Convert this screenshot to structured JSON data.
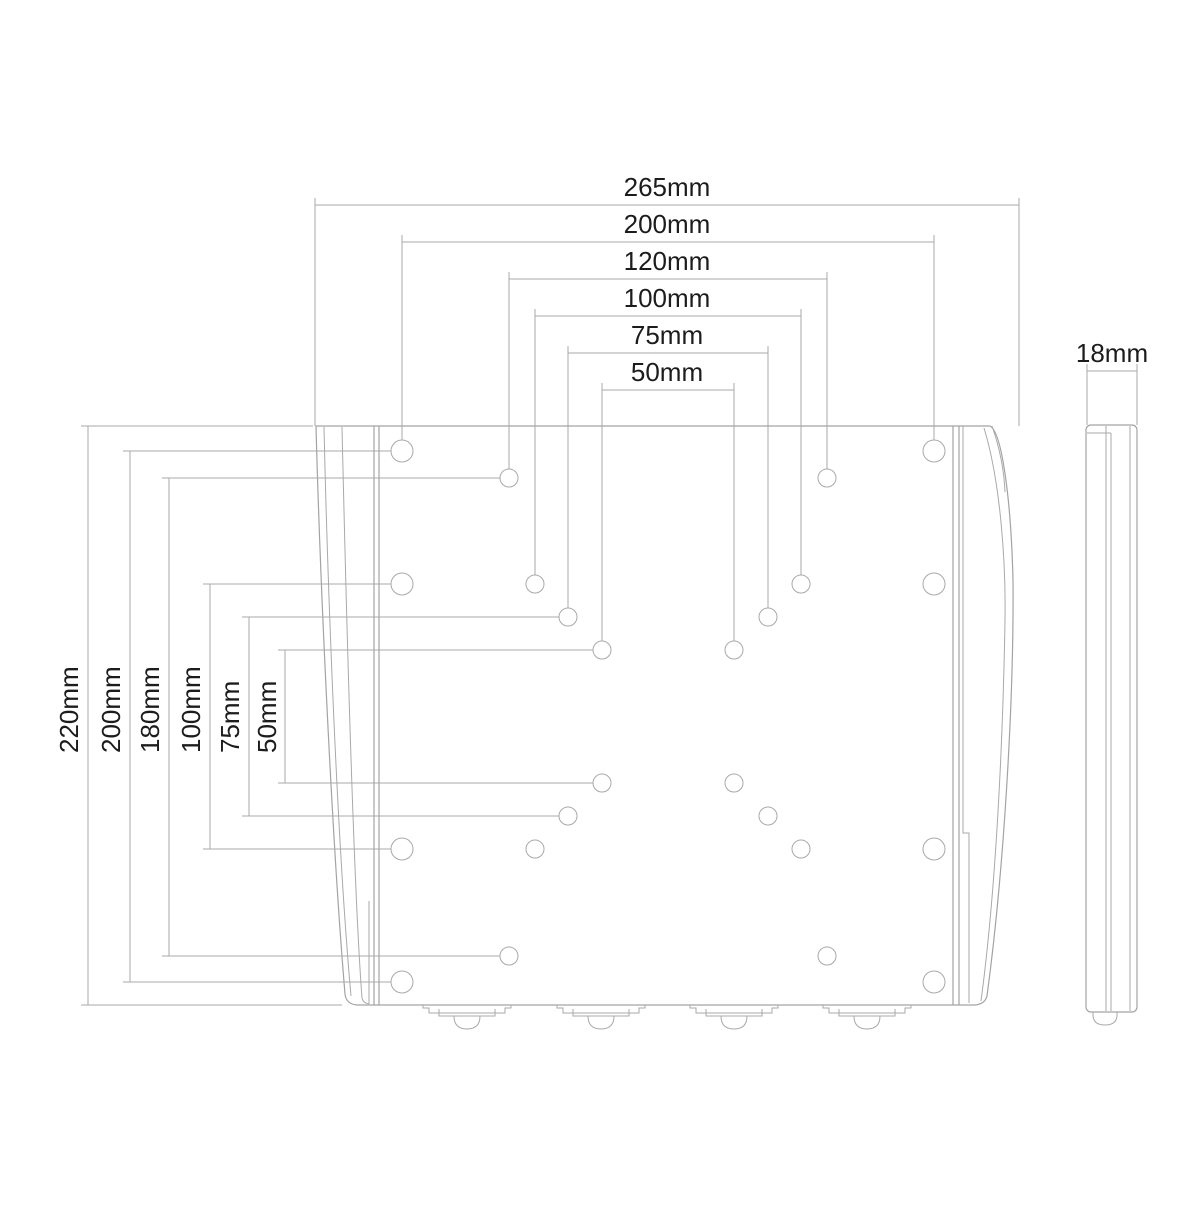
{
  "drawing": {
    "description": "VESA TV wall mount bracket dimensional drawing, front view and side view",
    "colors": {
      "line": "#a9a9a9",
      "plate_line": "#a3a3a3",
      "text": "#1c1c1c",
      "background": "#ffffff"
    },
    "front_view": {
      "plate": {
        "left": 316,
        "top": 426,
        "right": 1016,
        "bottom": 1005
      },
      "horizontal_dims": [
        {
          "label": "265mm",
          "value_mm": 265,
          "y": 205,
          "x1": 315,
          "x2": 1019,
          "ext_to": 426
        },
        {
          "label": "200mm",
          "value_mm": 200,
          "y": 242,
          "x1": 402,
          "x2": 934,
          "ext_to": 440
        },
        {
          "label": "120mm",
          "value_mm": 120,
          "y": 279,
          "x1": 509,
          "x2": 827,
          "ext_to": 469
        },
        {
          "label": "100mm",
          "value_mm": 100,
          "y": 316,
          "x1": 535,
          "x2": 801,
          "ext_to": 575
        },
        {
          "label": "75mm",
          "value_mm": 75,
          "y": 353,
          "x1": 568,
          "x2": 768,
          "ext_to": 608
        },
        {
          "label": "50mm",
          "value_mm": 50,
          "y": 390,
          "x1": 602,
          "x2": 734,
          "ext_to": 641
        }
      ],
      "vertical_dims": [
        {
          "label": "220mm",
          "value_mm": 220,
          "x": 88,
          "y1": 426,
          "y2": 1005,
          "ext_to1": 313,
          "ext_to2": 342,
          "label_x": 69
        },
        {
          "label": "200mm",
          "value_mm": 200,
          "x": 130,
          "y1": 451,
          "y2": 982,
          "ext_to1": 391,
          "ext_to2": 391,
          "label_x": 111
        },
        {
          "label": "180mm",
          "value_mm": 180,
          "x": 169,
          "y1": 478,
          "y2": 956,
          "ext_to1": 500,
          "ext_to2": 500,
          "label_x": 150
        },
        {
          "label": "100mm",
          "value_mm": 100,
          "x": 210,
          "y1": 584,
          "y2": 849,
          "ext_to1": 391,
          "ext_to2": 391,
          "label_x": 191
        },
        {
          "label": "75mm",
          "value_mm": 75,
          "x": 249,
          "y1": 617,
          "y2": 816,
          "ext_to1": 559,
          "ext_to2": 559,
          "label_x": 230
        },
        {
          "label": "50mm",
          "value_mm": 50,
          "x": 285,
          "y1": 650,
          "y2": 783,
          "ext_to1": 593,
          "ext_to2": 593,
          "label_x": 267
        }
      ],
      "holes": [
        {
          "x": 402,
          "y": 451,
          "r": 11
        },
        {
          "x": 934,
          "y": 451,
          "r": 11
        },
        {
          "x": 509,
          "y": 478,
          "r": 9
        },
        {
          "x": 827,
          "y": 478,
          "r": 9
        },
        {
          "x": 402,
          "y": 584,
          "r": 11
        },
        {
          "x": 535,
          "y": 584,
          "r": 9
        },
        {
          "x": 801,
          "y": 584,
          "r": 9
        },
        {
          "x": 934,
          "y": 584,
          "r": 11
        },
        {
          "x": 568,
          "y": 617,
          "r": 9
        },
        {
          "x": 768,
          "y": 617,
          "r": 9
        },
        {
          "x": 602,
          "y": 650,
          "r": 9
        },
        {
          "x": 734,
          "y": 650,
          "r": 9
        },
        {
          "x": 602,
          "y": 783,
          "r": 9
        },
        {
          "x": 734,
          "y": 783,
          "r": 9
        },
        {
          "x": 568,
          "y": 816,
          "r": 9
        },
        {
          "x": 768,
          "y": 816,
          "r": 9
        },
        {
          "x": 402,
          "y": 849,
          "r": 11
        },
        {
          "x": 535,
          "y": 849,
          "r": 9
        },
        {
          "x": 801,
          "y": 849,
          "r": 9
        },
        {
          "x": 934,
          "y": 849,
          "r": 11
        },
        {
          "x": 509,
          "y": 956,
          "r": 9
        },
        {
          "x": 827,
          "y": 956,
          "r": 9
        },
        {
          "x": 402,
          "y": 982,
          "r": 11
        },
        {
          "x": 934,
          "y": 982,
          "r": 11
        }
      ],
      "bottom_tabs": {
        "centers_x": [
          467,
          601,
          734,
          867
        ],
        "edge_y": 1005
      }
    },
    "side_view": {
      "dim": {
        "label": "18mm",
        "value_mm": 18,
        "y": 371,
        "x1": 1087,
        "x2": 1137,
        "ext_to": 425
      },
      "body": {
        "left": 1086,
        "top": 425,
        "right": 1137,
        "bottom": 1012
      }
    }
  }
}
